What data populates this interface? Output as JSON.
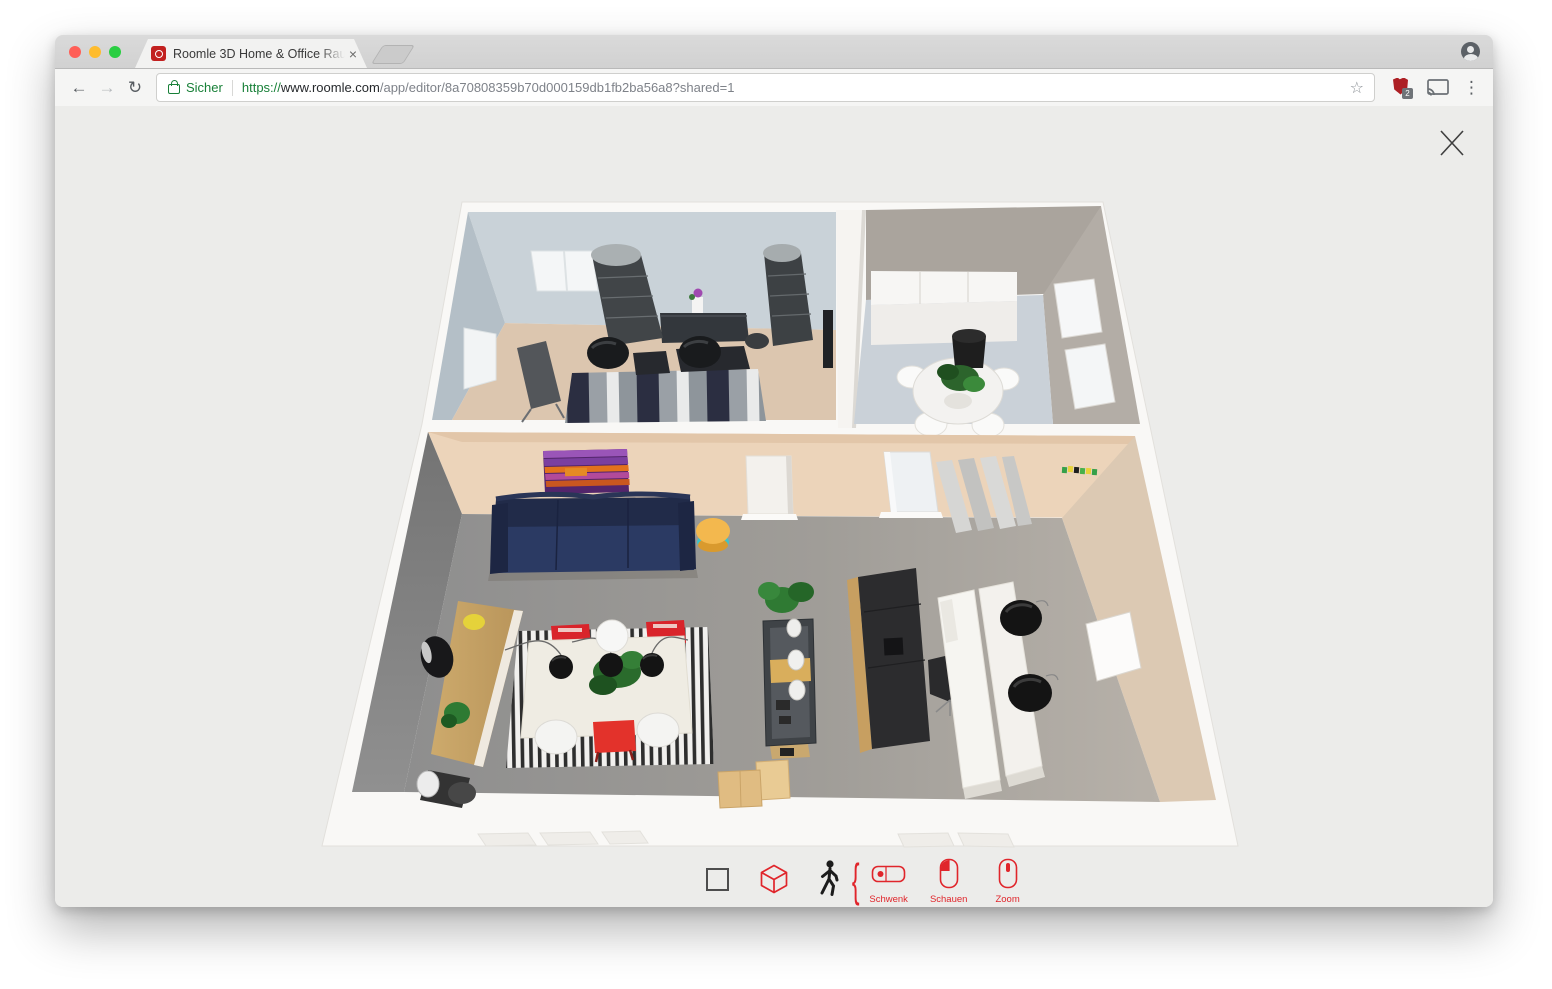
{
  "browser": {
    "traffic_lights": {
      "close": "#ff5f57",
      "minimize": "#febc2e",
      "zoom": "#2ace42"
    },
    "tab": {
      "title": "Roomle 3D Home & Office Rau",
      "close_glyph": "×"
    },
    "toolbar_icons": {
      "back": "←",
      "forward": "→",
      "reload": "↻",
      "star": "☆",
      "menu_dots": "⋮"
    },
    "address_bar": {
      "secure_label": "Sicher",
      "url_scheme": "https://",
      "url_host": "www.roomle.com",
      "url_path": "/app/editor/8a70808359b70d000159db1fb2ba56a8?shared=1",
      "extension_badge": "2"
    }
  },
  "viewer": {
    "accent_color": "#e0252b",
    "brace_glyph": "{",
    "mode_buttons": [
      "2d-view",
      "3d-view",
      "walkthrough"
    ],
    "mouse_hints": {
      "pan": "Schwenk",
      "look": "Schauen",
      "zoom": "Zoom"
    }
  },
  "scene": {
    "type": "3d-floorplan",
    "rooms": [
      {
        "name": "office",
        "wall_color": "#c9d2d8",
        "floor_color": "#dcc6af",
        "furniture": [
          "shelf-tower",
          "shelf-tower",
          "dark-sideboard-with-orchid",
          "flipchart-easel",
          "round-swivel-chair",
          "round-swivel-chair",
          "dark-desks",
          "striped-rug",
          "wall-window",
          "wall-window",
          "dark-door"
        ]
      },
      {
        "name": "meeting-room",
        "wall_color": "#aaa49d",
        "floor_color": "#cad1d8",
        "furniture": [
          "white-sideboard",
          "round-white-table",
          "white-chairs",
          "potted-plant",
          "wall-windows"
        ]
      },
      {
        "name": "living-work-room",
        "wall_color": "#ecd4ba",
        "floor_color": "#9b9b9b",
        "furniture": [
          "abstract-painting",
          "navy-sofa",
          "yellow-pouf",
          "wooden-sideboard",
          "yellow-lamp",
          "plants",
          "black-floor-lamp",
          "black-white-striped-rug",
          "dining-table",
          "red-chairs",
          "red-stool",
          "white-chairs",
          "pendant-lamps",
          "plant-shelf-unit",
          "black-kitchen-island",
          "office-chair",
          "white-desks",
          "black-round-chairs",
          "white-doors",
          "zigzag-shelf",
          "leaning-door-panel",
          "cardboard-boxes"
        ]
      }
    ]
  }
}
